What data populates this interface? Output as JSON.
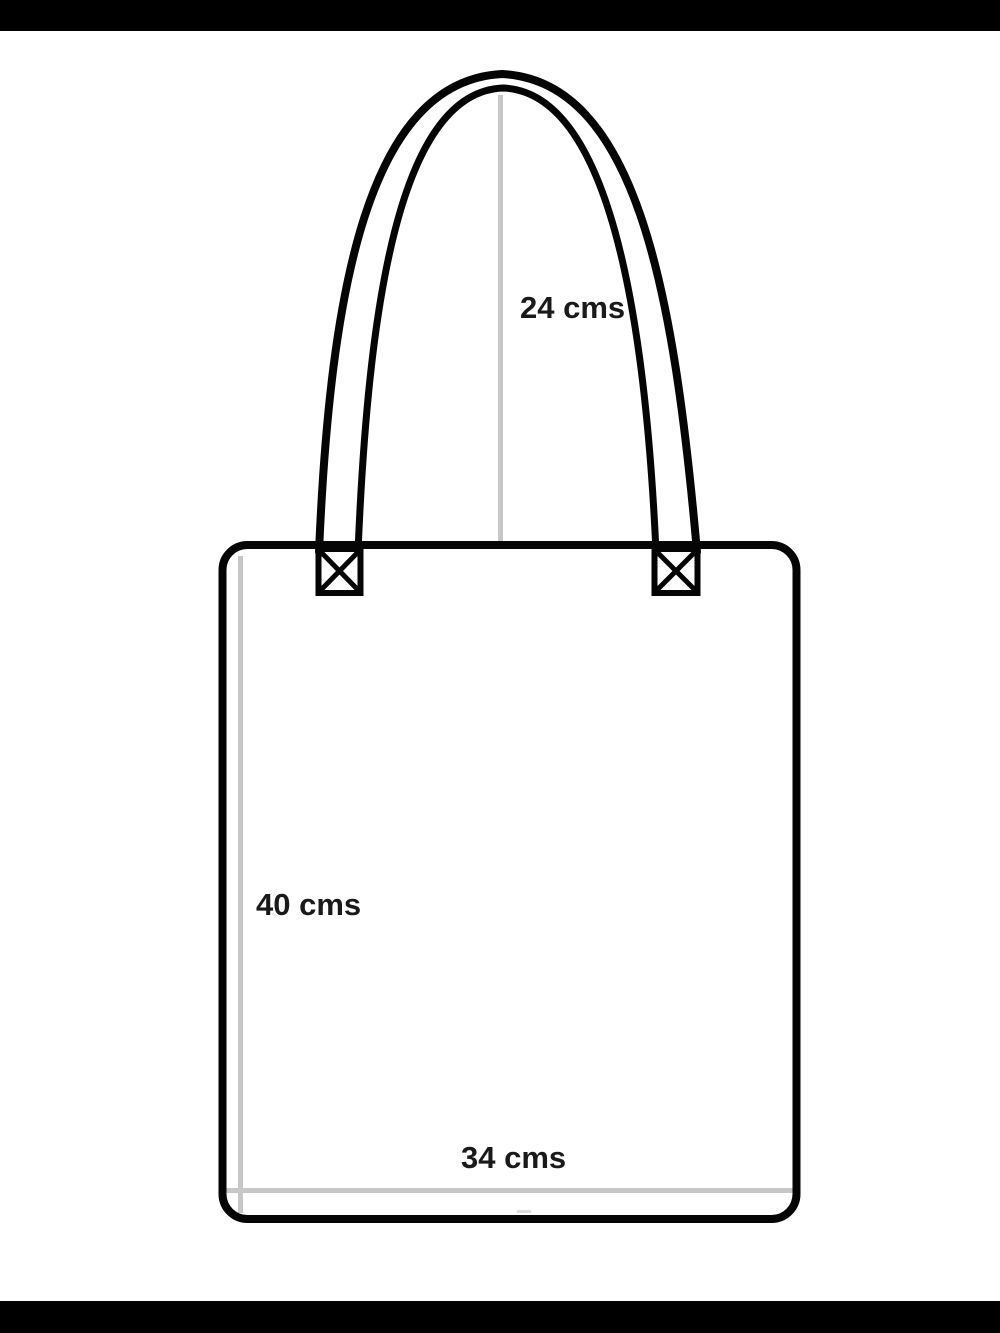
{
  "diagram": {
    "name": "Tote bag measurement diagram",
    "measurements": {
      "handle_drop": {
        "label": "24 cms"
      },
      "bag_height": {
        "label": "40 cms"
      },
      "bag_width": {
        "label": "34 cms"
      }
    },
    "colors": {
      "outline": "#050505",
      "label_text": "#1a1a1a",
      "guide_line": "#c7c7c7",
      "seam_mark": "#dcdcdc",
      "background": "#ffffff",
      "letterbox": "#000000"
    }
  }
}
